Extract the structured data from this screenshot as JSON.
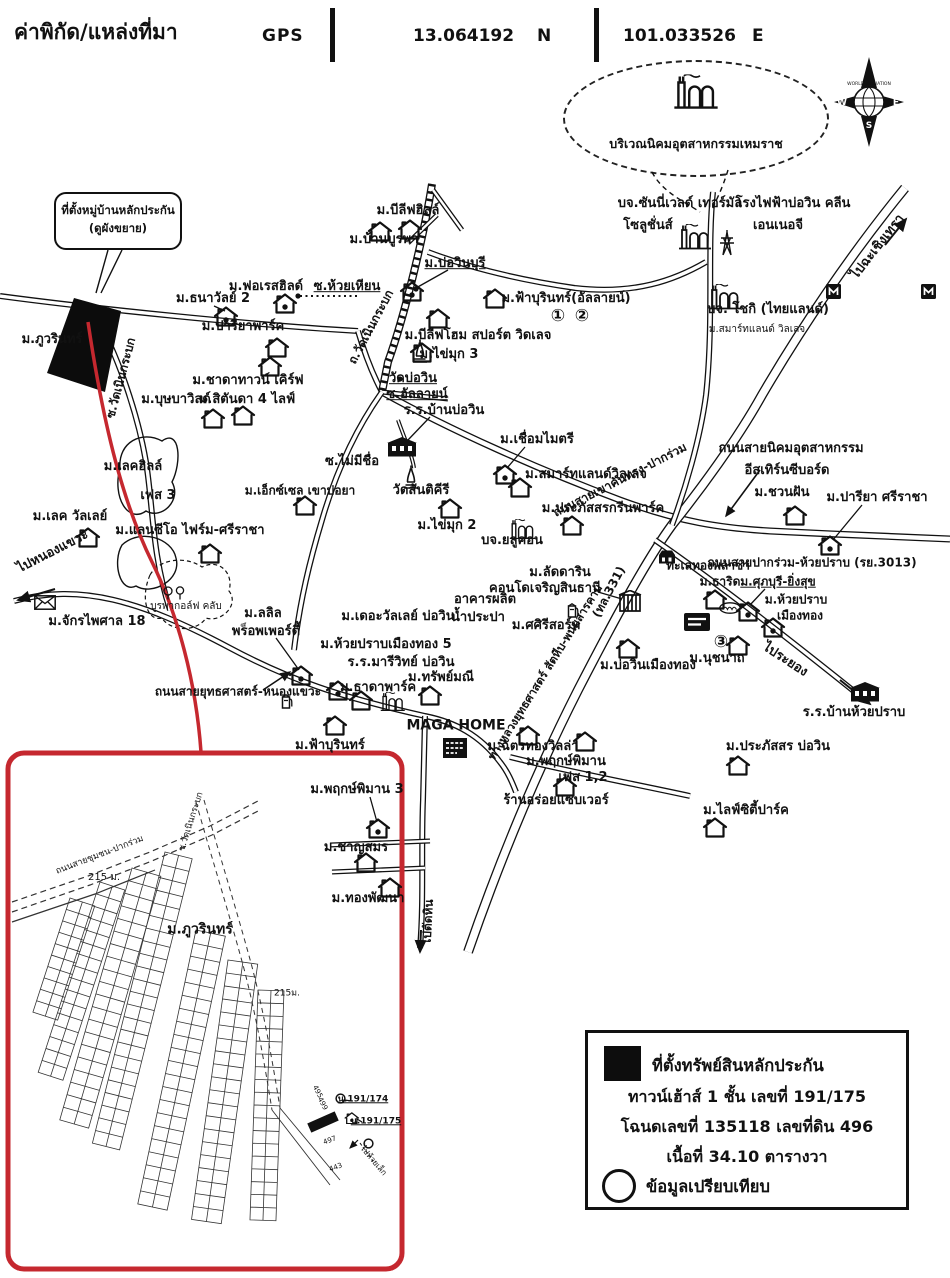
{
  "header": {
    "title": "ค่าพิกัด/แหล่งที่มา",
    "gps_label": "GPS",
    "lat": "13.064192",
    "lat_dir": "N",
    "lon": "101.033526",
    "lon_dir": "E"
  },
  "compass": {
    "west": "W",
    "east": "E",
    "south": "S",
    "brand": "WORLD VALUATION"
  },
  "industrial_estate": {
    "label": "บริเวณนิคมอุตสาหกรรมเหมราช"
  },
  "callout": {
    "line1": "ที่ตั้งหมู่บ้านหลักประกัน",
    "line2": "(ดูผังขยาย)"
  },
  "legend": {
    "property_marker_label": "ที่ตั้งทรัพย์สินหลักประกัน",
    "line2": "ทาวน์เฮ้าส์ 1 ชั้น เลขที่ 191/175",
    "line3": "โฉนดเลขที่ 135118 เลขที่ดิน 496",
    "line4": "เนื้อที่ 34.10 ตารางวา",
    "compare_label": "ข้อมูลเปรียบเทียบ"
  },
  "colors": {
    "accent_red": "#c5282f",
    "ink": "#111111"
  },
  "map": {
    "labels": [
      {
        "t": "ม.ภูวรินทร์",
        "x": 52,
        "y": 340
      },
      {
        "t": "ซ.วัดเนินกระบก",
        "x": 121,
        "y": 378,
        "r": -75,
        "s": 12
      },
      {
        "t": "ม.ธนาวัลย์ 2",
        "x": 213,
        "y": 299
      },
      {
        "t": "ม.ฟอเรสฮิลด์",
        "x": 266,
        "y": 287
      },
      {
        "t": "ซ.ห้วยเหียน",
        "x": 347,
        "y": 287,
        "u": 1
      },
      {
        "t": "ม.ปารียาพาร์ค",
        "x": 243,
        "y": 327
      },
      {
        "t": "ม.ชาดาทาวน์ เคิร์ฟ",
        "x": 248,
        "y": 381
      },
      {
        "t": "ม.สิตันดา 4 ไลฟ์",
        "x": 247,
        "y": 400
      },
      {
        "t": "ม.บุษบาวิลด์",
        "x": 176,
        "y": 400
      },
      {
        "t": "ม.บีลีฟฮิลล์",
        "x": 408,
        "y": 211
      },
      {
        "t": "ม.บ้านบูรพา",
        "x": 384,
        "y": 240
      },
      {
        "t": "ม.บ่อวินบุรี",
        "x": 455,
        "y": 264,
        "u": 1
      },
      {
        "t": "ถ.วัดเนินกระบก",
        "x": 371,
        "y": 327,
        "r": -62,
        "s": 12
      },
      {
        "t": "ม.ฟ้าบุรินทร์(อัลลายน์)",
        "x": 566,
        "y": 299
      },
      {
        "t": "①",
        "x": 558,
        "y": 317,
        "s": 17
      },
      {
        "t": "②",
        "x": 582,
        "y": 317,
        "s": 17
      },
      {
        "t": "ม.บีลีฟโฮม สปอร์ต วิดเลจ",
        "x": 478,
        "y": 336
      },
      {
        "t": "ม.ไข่มุก 3",
        "x": 449,
        "y": 355
      },
      {
        "t": "วัดบ่อวิน",
        "x": 413,
        "y": 379,
        "u": 1
      },
      {
        "t": "ซ.อัลลายน์",
        "x": 417,
        "y": 395,
        "u": 1
      },
      {
        "t": "ร.ร.บ้านบ่อวิน",
        "x": 444,
        "y": 411
      },
      {
        "t": "บจ.ซันนี่เวลด์ เทอร์มัล",
        "x": 680,
        "y": 204
      },
      {
        "t": "โซลูชั่นส์",
        "x": 648,
        "y": 226
      },
      {
        "t": "โรงไฟฟ้าบ่อวิน คลีน",
        "x": 793,
        "y": 204
      },
      {
        "t": "เอนเนอจี",
        "x": 778,
        "y": 226
      },
      {
        "t": "บจ. โชกิ (ไทยแลนด์)",
        "x": 768,
        "y": 310
      },
      {
        "t": "ม.สมาร์ทแลนด์ วิลเลจ",
        "x": 757,
        "y": 330,
        "s": 10,
        "w": 400
      },
      {
        "t": "ไปฉะเชิงเทรา",
        "x": 878,
        "y": 247,
        "r": -52
      },
      {
        "t": "ถนนสายนิคมอุตสาหกรรม",
        "x": 791,
        "y": 449
      },
      {
        "t": "อีสเทิร์นซีบอร์ด",
        "x": 787,
        "y": 471
      },
      {
        "t": "ม.ชวนฝัน",
        "x": 782,
        "y": 493
      },
      {
        "t": "ม.ปารียา ศรีราชา",
        "x": 877,
        "y": 498
      },
      {
        "t": "ทะเลทองพลาซ่า",
        "x": 708,
        "y": 566,
        "s": 12
      },
      {
        "t": "ถนนสายปากร่วม-ห้วยปราบ (รย.3013)",
        "x": 812,
        "y": 563,
        "s": 12
      },
      {
        "t": "ซ.ไม่มีชื่อ",
        "x": 352,
        "y": 462
      },
      {
        "t": "วัดสันติคีรี",
        "x": 421,
        "y": 491
      },
      {
        "t": "ม.ไข่มุก 2",
        "x": 447,
        "y": 526
      },
      {
        "t": "ม.เชื่อมไมตรี",
        "x": 537,
        "y": 440
      },
      {
        "t": "ม.สมาร์ทแลนด์วิลเลจ",
        "x": 586,
        "y": 475
      },
      {
        "t": "ม.ประภัสสรกรีนพาร์ค",
        "x": 603,
        "y": 509
      },
      {
        "t": "บจ.ยลูคอน",
        "x": 512,
        "y": 541
      },
      {
        "t": "ถนนสายเขาคันทรง-ปากร่วม",
        "x": 620,
        "y": 480,
        "r": -27,
        "s": 12
      },
      {
        "t": "ม.ลัดดาริน",
        "x": 560,
        "y": 573
      },
      {
        "t": "คอนโดเจริญสินธานี",
        "x": 545,
        "y": 589
      },
      {
        "t": "อาคารผลิต",
        "x": 485,
        "y": 600
      },
      {
        "t": "น้ำประปา",
        "x": 478,
        "y": 618
      },
      {
        "t": "ม.ศศิรีสอร์ท",
        "x": 546,
        "y": 626
      },
      {
        "t": "ม.เดอะวัลเลย์ บ่อวิน",
        "x": 398,
        "y": 617
      },
      {
        "t": "(ทล.331)",
        "x": 609,
        "y": 592,
        "r": -62,
        "s": 12
      },
      {
        "t": "ทางหลวงยุทธศาสตร์ สัตหีบ-พนมสารคาม",
        "x": 545,
        "y": 672,
        "r": -58,
        "s": 11.5
      },
      {
        "t": "ม.เลคฮิลล์",
        "x": 133,
        "y": 467
      },
      {
        "t": "เฟส 3",
        "x": 158,
        "y": 496
      },
      {
        "t": "ม.เลค วัลเลย์",
        "x": 70,
        "y": 517
      },
      {
        "t": "ม.แลนซีโอ ไฟร์ม-ศรีราชา",
        "x": 190,
        "y": 531
      },
      {
        "t": "ม.เอ็กซ์เซล เขาบ่อยา",
        "x": 300,
        "y": 491,
        "s": 12
      },
      {
        "t": "ไปหนองแขวะ",
        "x": 53,
        "y": 552,
        "r": -27
      },
      {
        "t": "ม.จักรไพศาล 18",
        "x": 97,
        "y": 622
      },
      {
        "t": "บูรพากอล์ฟ คลับ",
        "x": 186,
        "y": 607,
        "s": 10,
        "w": 400
      },
      {
        "t": "ม.ลลิล",
        "x": 263,
        "y": 614
      },
      {
        "t": "พร็อพเพอร์ตี้",
        "x": 266,
        "y": 632
      },
      {
        "t": "ถนนสายยุทธศาสตร์-หนองแขวะ",
        "x": 238,
        "y": 692,
        "s": 12
      },
      {
        "t": "ม.ห้วยปราบเมืองทอง 5",
        "x": 386,
        "y": 645
      },
      {
        "t": "ร.ร.มารีวิทย์ บ่อวิน",
        "x": 401,
        "y": 663
      },
      {
        "t": "ม.ธาดาพาร์ค",
        "x": 378,
        "y": 688
      },
      {
        "t": "ม.ทรัพย์มณี",
        "x": 441,
        "y": 678
      },
      {
        "t": "MAGA HOME",
        "x": 456,
        "y": 726,
        "s": 14
      },
      {
        "t": "ม.ฉัตรทองวิลล่า",
        "x": 533,
        "y": 747
      },
      {
        "t": "ม.พฤกษ์พิมาน",
        "x": 566,
        "y": 762
      },
      {
        "t": "เฟส 1,2",
        "x": 583,
        "y": 778
      },
      {
        "t": "ร้านอร่อยแซบเวอร์",
        "x": 556,
        "y": 801
      },
      {
        "t": "ม.ฟ้าบุรินทร์",
        "x": 330,
        "y": 746
      },
      {
        "t": "ม.พฤกษ์พิมาน 3",
        "x": 357,
        "y": 790
      },
      {
        "t": "ม.ชาญสมร",
        "x": 356,
        "y": 848
      },
      {
        "t": "ม.ทองพัฒนา",
        "x": 368,
        "y": 899
      },
      {
        "t": "ไปตัดหิน",
        "x": 428,
        "y": 922,
        "r": -87,
        "s": 12
      },
      {
        "t": "ม.บ่อวินเมืองทอง",
        "x": 648,
        "y": 666
      },
      {
        "t": "③",
        "x": 721,
        "y": 643,
        "s": 17
      },
      {
        "t": "ม.นุชนาถ",
        "x": 717,
        "y": 659
      },
      {
        "t": "ไประยอง",
        "x": 785,
        "y": 660,
        "r": 33
      },
      {
        "t": "ร.ร.บ้านห้วยปราบ",
        "x": 854,
        "y": 713
      },
      {
        "t": "ม.ประภัสสร บ่อวิน",
        "x": 778,
        "y": 747
      },
      {
        "t": "ม.ไลฟ์ซิตี้ปาร์ค",
        "x": 746,
        "y": 811
      },
      {
        "t": "ม.ธาริด",
        "x": 720,
        "y": 582,
        "s": 12
      },
      {
        "t": "ม.ศุภบุรี-ยิ่งสุข",
        "x": 778,
        "y": 582,
        "u": 1,
        "s": 12
      },
      {
        "t": "ม.ห้วยปราบ",
        "x": 796,
        "y": 600,
        "s": 12
      },
      {
        "t": "เมืองทอง",
        "x": 800,
        "y": 616,
        "s": 12
      },
      {
        "t": "ถนนสายชุมชน-ปากร่วม",
        "x": 100,
        "y": 856,
        "r": -21,
        "s": 9,
        "w": 400
      },
      {
        "t": "215 ม.",
        "x": 104,
        "y": 878,
        "s": 10,
        "w": 400
      },
      {
        "t": "ซ.วัดเนินกระบก",
        "x": 192,
        "y": 822,
        "r": -72,
        "s": 9,
        "w": 400
      },
      {
        "t": "ม.ภูวรินทร์",
        "x": 200,
        "y": 930,
        "s": 14
      },
      {
        "t": "215ม.",
        "x": 287,
        "y": 994,
        "s": 9,
        "w": 400
      },
      {
        "t": "495",
        "x": 317,
        "y": 1092,
        "r": 62,
        "s": 7,
        "w": 400
      },
      {
        "t": "499",
        "x": 322,
        "y": 1104,
        "r": 62,
        "s": 7,
        "w": 400
      },
      {
        "t": "497",
        "x": 330,
        "y": 1141,
        "r": -20,
        "s": 7,
        "w": 400
      },
      {
        "t": "443",
        "x": 336,
        "y": 1168,
        "r": -20,
        "s": 7,
        "w": 400
      },
      {
        "t": "น.191/174",
        "x": 363,
        "y": 1100,
        "s": 9,
        "u": 1
      },
      {
        "t": "น.191/175",
        "x": 376,
        "y": 1122,
        "s": 9,
        "u": 1
      },
      {
        "t": "ไปห้วยเล็ก",
        "x": 373,
        "y": 1161,
        "r": 50,
        "s": 8,
        "w": 400
      }
    ],
    "icons": [
      {
        "n": "house",
        "x": 380,
        "y": 231
      },
      {
        "n": "house",
        "x": 410,
        "y": 229
      },
      {
        "n": "house",
        "x": 277,
        "y": 347
      },
      {
        "n": "house",
        "x": 270,
        "y": 366
      },
      {
        "n": "house",
        "x": 243,
        "y": 415
      },
      {
        "n": "house",
        "x": 213,
        "y": 418
      },
      {
        "n": "house",
        "x": 495,
        "y": 298
      },
      {
        "n": "house",
        "x": 438,
        "y": 318
      },
      {
        "n": "house",
        "x": 422,
        "y": 352
      },
      {
        "n": "house",
        "x": 450,
        "y": 508
      },
      {
        "n": "house",
        "x": 520,
        "y": 487
      },
      {
        "n": "house",
        "x": 572,
        "y": 525
      },
      {
        "n": "house",
        "x": 795,
        "y": 515
      },
      {
        "n": "house",
        "x": 88,
        "y": 537
      },
      {
        "n": "house",
        "x": 210,
        "y": 553
      },
      {
        "n": "house",
        "x": 305,
        "y": 505
      },
      {
        "n": "house",
        "x": 628,
        "y": 648
      },
      {
        "n": "house",
        "x": 738,
        "y": 645
      },
      {
        "n": "house",
        "x": 715,
        "y": 599
      },
      {
        "n": "house",
        "x": 738,
        "y": 765
      },
      {
        "n": "house",
        "x": 715,
        "y": 827
      },
      {
        "n": "house",
        "x": 528,
        "y": 735
      },
      {
        "n": "house",
        "x": 585,
        "y": 741
      },
      {
        "n": "house",
        "x": 430,
        "y": 695
      },
      {
        "n": "house",
        "x": 361,
        "y": 700
      },
      {
        "n": "house",
        "x": 366,
        "y": 862
      },
      {
        "n": "house",
        "x": 390,
        "y": 887
      },
      {
        "n": "house",
        "x": 335,
        "y": 725
      },
      {
        "n": "house",
        "x": 565,
        "y": 786
      },
      {
        "n": "house-dot",
        "x": 412,
        "y": 291
      },
      {
        "n": "house-dot",
        "x": 226,
        "y": 316
      },
      {
        "n": "house-dot",
        "x": 285,
        "y": 303
      },
      {
        "n": "house-dot",
        "x": 505,
        "y": 474
      },
      {
        "n": "house-dot",
        "x": 830,
        "y": 545
      },
      {
        "n": "house-dot",
        "x": 748,
        "y": 611
      },
      {
        "n": "house-dot",
        "x": 773,
        "y": 627
      },
      {
        "n": "house-dot",
        "x": 301,
        "y": 675
      },
      {
        "n": "house-dot",
        "x": 338,
        "y": 690
      },
      {
        "n": "house-dot",
        "x": 378,
        "y": 828
      },
      {
        "n": "house-dot",
        "x": 352,
        "y": 1118,
        "sc": 0.6
      },
      {
        "n": "factory",
        "x": 695,
        "y": 237
      },
      {
        "n": "factory",
        "x": 725,
        "y": 297
      },
      {
        "n": "factory",
        "x": 523,
        "y": 529,
        "sc": 0.8
      },
      {
        "n": "factory",
        "x": 393,
        "y": 702,
        "sc": 0.75
      },
      {
        "n": "tower",
        "x": 727,
        "y": 243
      },
      {
        "n": "temple",
        "x": 420,
        "y": 351
      },
      {
        "n": "temple",
        "x": 411,
        "y": 477
      },
      {
        "n": "school",
        "x": 402,
        "y": 447
      },
      {
        "n": "school",
        "x": 865,
        "y": 692
      },
      {
        "n": "condo",
        "x": 630,
        "y": 601
      },
      {
        "n": "envelope",
        "x": 45,
        "y": 602
      },
      {
        "n": "pump",
        "x": 287,
        "y": 701
      },
      {
        "n": "pump",
        "x": 573,
        "y": 610
      },
      {
        "n": "msign",
        "x": 833,
        "y": 291
      },
      {
        "n": "msign",
        "x": 928,
        "y": 291
      },
      {
        "n": "mall",
        "x": 667,
        "y": 557
      },
      {
        "n": "lotus",
        "x": 730,
        "y": 608
      },
      {
        "n": "storesign",
        "x": 697,
        "y": 622
      },
      {
        "n": "magasign",
        "x": 455,
        "y": 748
      },
      {
        "n": "trees",
        "x": 175,
        "y": 593
      },
      {
        "n": "markcircle",
        "x": 340,
        "y": 1098
      },
      {
        "n": "markcircle",
        "x": 368,
        "y": 1143
      }
    ]
  }
}
